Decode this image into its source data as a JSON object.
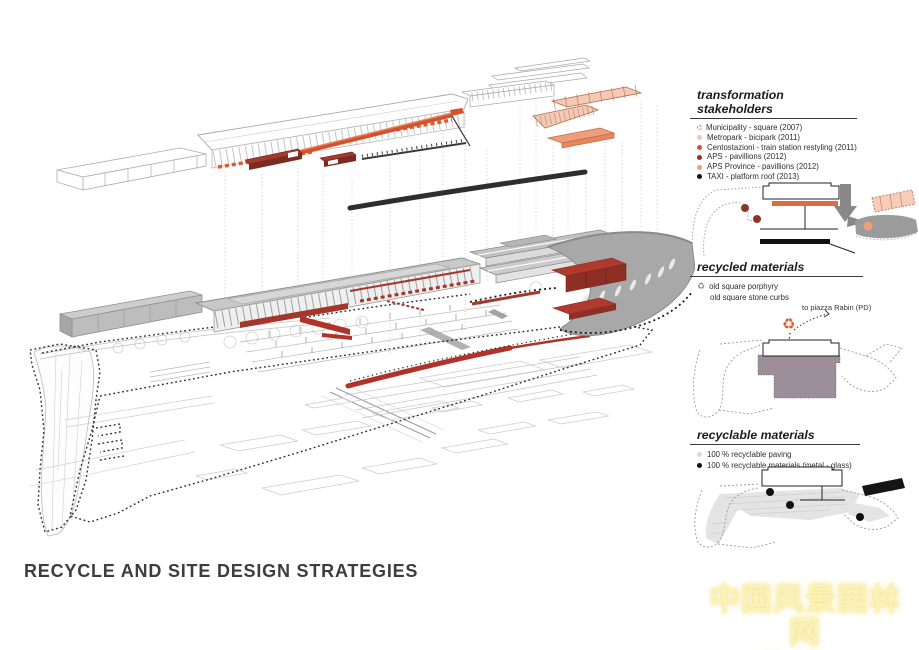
{
  "title": "RECYCLE AND SITE DESIGN STRATEGIES",
  "panels": {
    "stakeholders": {
      "title": "transformation stakeholders",
      "items": [
        {
          "label": "Municipality - square (2007)",
          "icon": "dashed-circle",
          "color": "#b5b5b5"
        },
        {
          "label": "Metropark - bicipark (2011)",
          "icon": "dot",
          "color": "#f2c7b2"
        },
        {
          "label": "Centostazioni - train station restyling (2011)",
          "icon": "dot",
          "color": "#d5502b"
        },
        {
          "label": "APS - pavillions (2012)",
          "icon": "dot",
          "color": "#8e352a"
        },
        {
          "label": "APS Province - pavillions (2012)",
          "icon": "dot",
          "color": "#ef9d7b"
        },
        {
          "label": "TAXI - platform roof (2013)",
          "icon": "dot",
          "color": "#111111"
        }
      ]
    },
    "recycled": {
      "title": "recycled materials",
      "icon_glyph": "♻",
      "items": [
        {
          "label": "old square porphyry"
        },
        {
          "label": "old square stone curbs"
        }
      ],
      "annotation": "to piazza Rabin (PD)"
    },
    "recyclable": {
      "title": "recyclable materials",
      "items": [
        {
          "label": "100 % recyclable paving",
          "color": "#d9d9d9"
        },
        {
          "label": "100 % recyclable materials (metal - glass)",
          "color": "#111111"
        }
      ]
    }
  },
  "watermark": {
    "text": "中国风景园林网",
    "url": "chla.com.cn"
  },
  "colors": {
    "orange_restyling": "#d5502b",
    "dark_red_pavilion": "#8e352a",
    "salmon_pavilion": "#ef9d7b",
    "light_salmon_bicipark": "#f2c7b2",
    "black_platform": "#111111",
    "gray_canopy": "#a8a8a8",
    "purple_gray_square": "#9c8f99",
    "red_ground_canopy": "#b03228"
  }
}
